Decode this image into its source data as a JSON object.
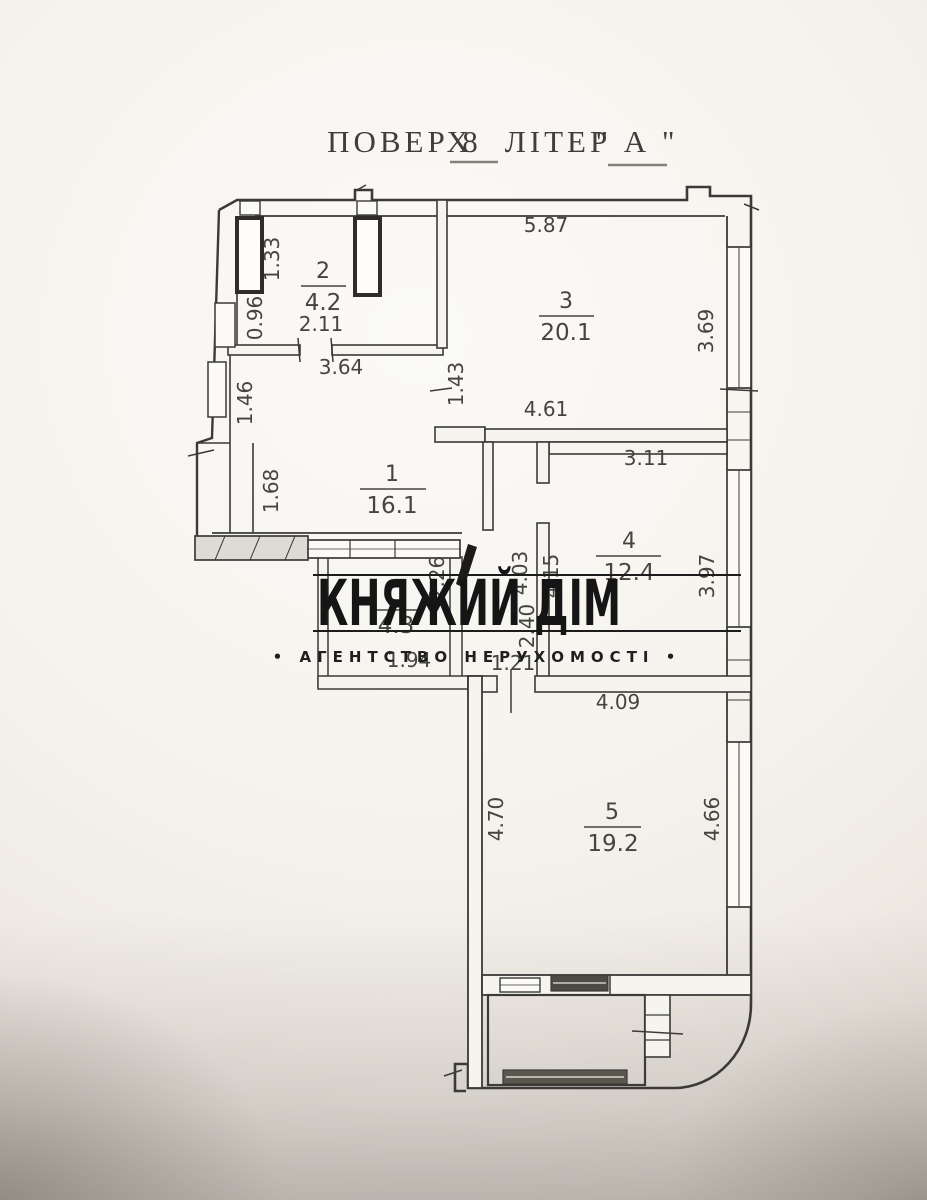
{
  "title": {
    "floor_label": "ПОВЕРХ",
    "floor_value": "8",
    "letter_label": "ЛІТЕР",
    "letter_value": "\" А \""
  },
  "watermark": {
    "name": "КНЯЖИЙ ДІМ",
    "tagline": "• АГЕНТСТВО НЕРУХОМОСТІ •"
  },
  "rooms": [
    {
      "number": "1",
      "area": "16.1"
    },
    {
      "number": "2",
      "area": "4.2"
    },
    {
      "number": "3",
      "area": "20.1"
    },
    {
      "number": "4",
      "area": "12.4"
    },
    {
      "number": "5",
      "area": "19.2"
    },
    {
      "number": "",
      "area": "4.3"
    }
  ],
  "dims": {
    "room3_top": "5.87",
    "room2_width": "2.11",
    "room1_top": "3.64",
    "room3_bottom": "4.61",
    "room4_top": "3.11",
    "loggia_width": "1.94",
    "hall_width": "1.21",
    "room5_top": "4.09",
    "shaft_left": "1.33",
    "room2_left": "0.96",
    "opening_1_3": "1.43",
    "room3_window": "3.69",
    "room1_left_upper": "1.46",
    "room1_left_lower": "1.68",
    "loggia_height": "2.26",
    "hall_height": "4.03",
    "room4_left": "4.15",
    "hall_lower": "2.40",
    "room4_window": "3.97",
    "room5_left": "4.70",
    "room5_right": "4.66"
  },
  "colors": {
    "ink": "#3b3a37",
    "label": "#45443f",
    "watermark": "#161616",
    "paper_light": "#fbfaf7",
    "paper_dark": "#beb8af"
  }
}
